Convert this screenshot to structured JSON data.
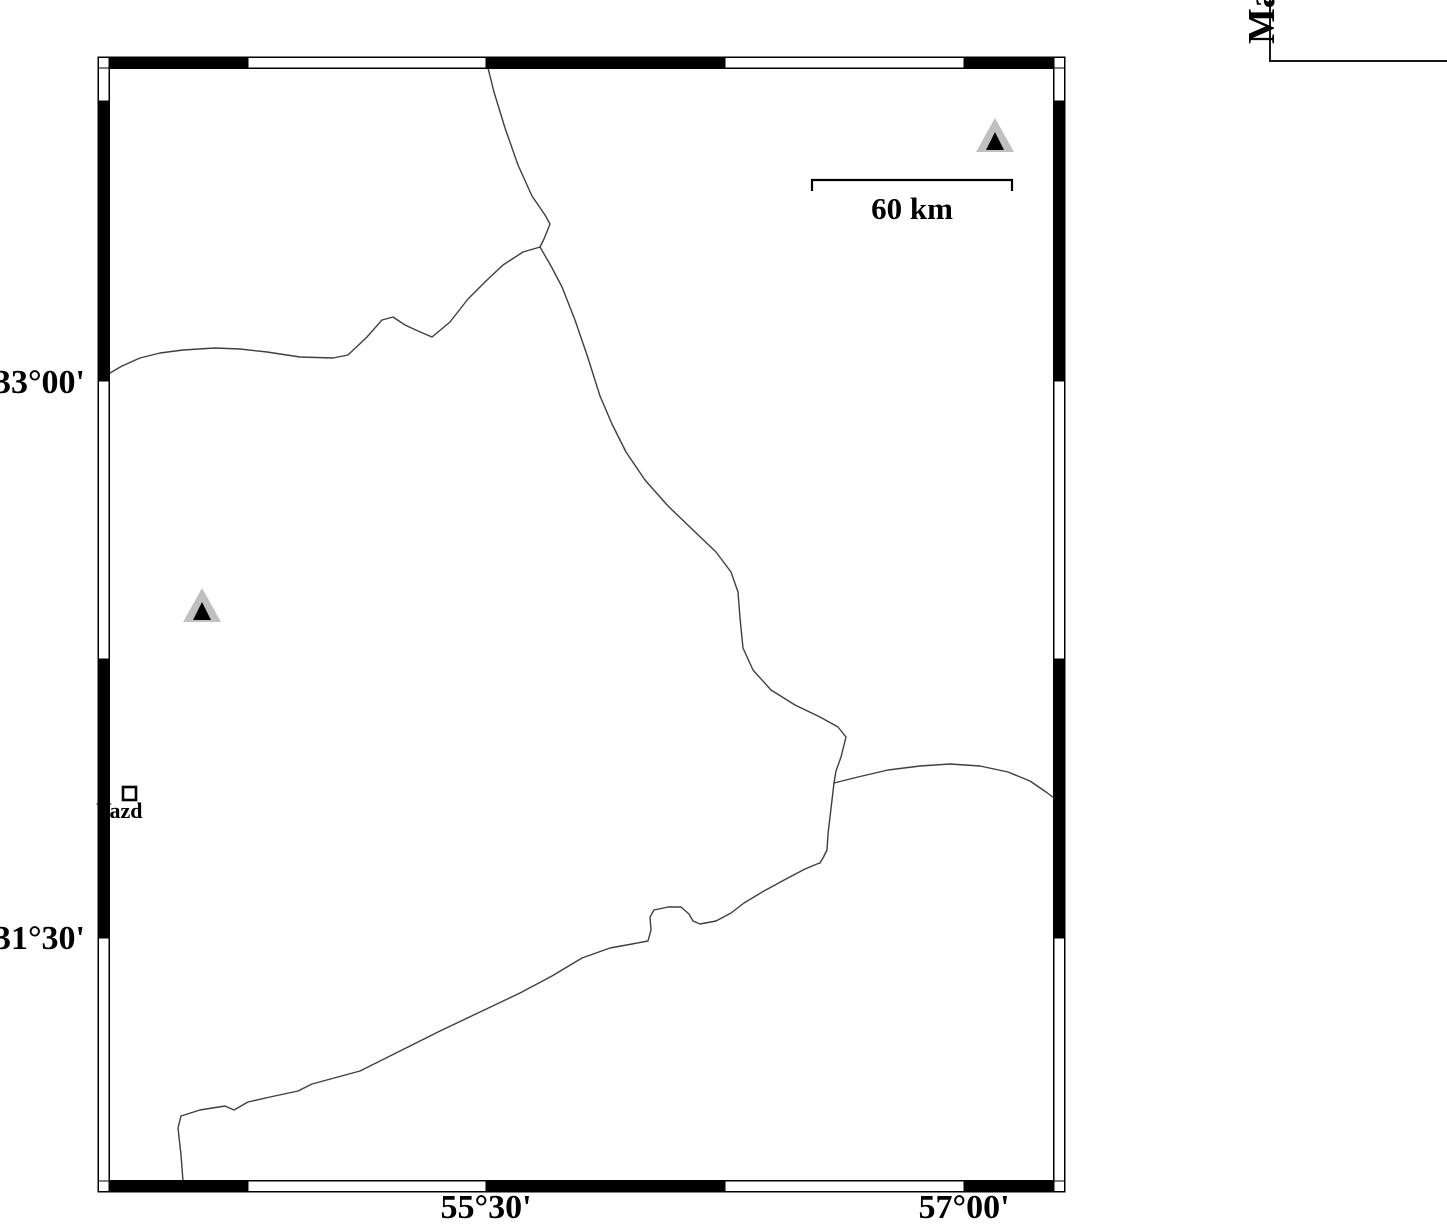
{
  "page": {
    "width": 1447,
    "height": 1229,
    "background": "#ffffff"
  },
  "colors": {
    "line": "#3f3f3f",
    "frame_black": "#000000",
    "frame_white": "#ffffff",
    "triangle_fill": "#c0c0c0",
    "triangle_core": "#000000",
    "ink": "#000000"
  },
  "map": {
    "axis": {
      "left_labels": [
        {
          "text": "33°00'",
          "y": 381
        },
        {
          "text": "31°30'",
          "y": 938
        }
      ],
      "bottom_labels": [
        {
          "text": "55°30'",
          "x": 486
        },
        {
          "text": "57°00'",
          "x": 964
        }
      ]
    },
    "frame": {
      "outer": [
        98,
        57,
        1065,
        1192
      ],
      "inner": [
        109,
        68,
        1054,
        1181
      ],
      "top_segments": [
        [
          109,
          248,
          "#000000"
        ],
        [
          248,
          486,
          "#ffffff"
        ],
        [
          486,
          725,
          "#000000"
        ],
        [
          725,
          964,
          "#ffffff"
        ],
        [
          964,
          1054,
          "#000000"
        ]
      ],
      "bottom_segments": [
        [
          109,
          248,
          "#000000"
        ],
        [
          248,
          486,
          "#ffffff"
        ],
        [
          486,
          725,
          "#000000"
        ],
        [
          725,
          964,
          "#ffffff"
        ],
        [
          964,
          1054,
          "#000000"
        ]
      ],
      "left_segments": [
        [
          68,
          101,
          "#ffffff"
        ],
        [
          101,
          381,
          "#000000"
        ],
        [
          381,
          659,
          "#ffffff"
        ],
        [
          659,
          938,
          "#000000"
        ],
        [
          938,
          1181,
          "#ffffff"
        ]
      ],
      "right_segments": [
        [
          68,
          101,
          "#ffffff"
        ],
        [
          101,
          381,
          "#000000"
        ],
        [
          381,
          659,
          "#ffffff"
        ],
        [
          659,
          938,
          "#000000"
        ],
        [
          938,
          1181,
          "#ffffff"
        ]
      ]
    },
    "scale_bar": {
      "x1": 812,
      "x2": 1012,
      "y": 180,
      "tick": 11,
      "label": "60 km"
    },
    "city": {
      "label": "Yazd",
      "square": [
        123,
        787,
        13,
        13
      ]
    },
    "markers": [
      {
        "name": "station-triangle-ne",
        "cx": 995,
        "base_y": 152
      },
      {
        "name": "station-triangle-w",
        "cx": 202,
        "base_y": 622
      }
    ],
    "legend": {
      "visible_title": "Ma"
    },
    "lines": [
      {
        "name": "boundary-line-west",
        "points": [
          [
            110,
            373
          ],
          [
            122,
            366
          ],
          [
            140,
            358
          ],
          [
            160,
            353
          ],
          [
            183,
            350
          ],
          [
            215,
            348
          ],
          [
            240,
            349
          ],
          [
            267,
            352
          ],
          [
            300,
            357
          ],
          [
            333,
            358
          ],
          [
            348,
            355
          ],
          [
            367,
            337
          ],
          [
            382,
            320
          ],
          [
            393,
            317
          ],
          [
            405,
            325
          ],
          [
            418,
            331
          ],
          [
            432,
            337
          ],
          [
            450,
            322
          ],
          [
            468,
            299
          ],
          [
            486,
            281
          ],
          [
            503,
            265
          ],
          [
            523,
            252
          ],
          [
            540,
            247
          ]
        ]
      },
      {
        "name": "boundary-line-north",
        "points": [
          [
            488,
            68
          ],
          [
            494,
            92
          ],
          [
            505,
            128
          ],
          [
            518,
            165
          ],
          [
            532,
            196
          ],
          [
            545,
            215
          ],
          [
            550,
            224
          ],
          [
            544,
            239
          ],
          [
            540,
            247
          ]
        ]
      },
      {
        "name": "boundary-line-southeast",
        "points": [
          [
            540,
            247
          ],
          [
            551,
            266
          ],
          [
            562,
            287
          ],
          [
            575,
            320
          ],
          [
            588,
            358
          ],
          [
            600,
            396
          ],
          [
            612,
            424
          ],
          [
            626,
            452
          ],
          [
            645,
            480
          ],
          [
            668,
            506
          ],
          [
            693,
            530
          ],
          [
            716,
            552
          ],
          [
            731,
            572
          ],
          [
            738,
            592
          ],
          [
            740,
            618
          ],
          [
            743,
            648
          ],
          [
            753,
            670
          ],
          [
            771,
            690
          ],
          [
            795,
            705
          ],
          [
            820,
            717
          ],
          [
            838,
            727
          ],
          [
            846,
            737
          ],
          [
            841,
            757
          ],
          [
            836,
            771
          ],
          [
            834,
            783
          ]
        ]
      },
      {
        "name": "boundary-line-east",
        "points": [
          [
            834,
            783
          ],
          [
            858,
            777
          ],
          [
            888,
            770
          ],
          [
            920,
            766
          ],
          [
            950,
            764
          ],
          [
            980,
            766
          ],
          [
            1008,
            772
          ],
          [
            1030,
            781
          ],
          [
            1046,
            792
          ],
          [
            1054,
            798
          ]
        ]
      },
      {
        "name": "boundary-line-south-branch",
        "points": [
          [
            834,
            783
          ],
          [
            832,
            800
          ],
          [
            830,
            817
          ],
          [
            828,
            834
          ],
          [
            827,
            850
          ],
          [
            823,
            858
          ],
          [
            820,
            863
          ]
        ]
      },
      {
        "name": "boundary-line-southwest",
        "points": [
          [
            183,
            1181
          ],
          [
            181,
            1155
          ],
          [
            178,
            1128
          ],
          [
            181,
            1116
          ],
          [
            200,
            1110
          ],
          [
            225,
            1106
          ],
          [
            234,
            1110
          ],
          [
            248,
            1102
          ],
          [
            270,
            1097
          ],
          [
            298,
            1091
          ],
          [
            312,
            1084
          ],
          [
            360,
            1071
          ],
          [
            400,
            1051
          ],
          [
            440,
            1031
          ],
          [
            480,
            1012
          ],
          [
            520,
            993
          ],
          [
            552,
            976
          ],
          [
            582,
            958
          ],
          [
            610,
            948
          ],
          [
            632,
            944
          ],
          [
            648,
            941
          ],
          [
            651,
            930
          ],
          [
            650,
            917
          ],
          [
            654,
            910
          ],
          [
            668,
            907
          ],
          [
            681,
            907
          ],
          [
            689,
            914
          ],
          [
            693,
            921
          ],
          [
            700,
            924
          ],
          [
            716,
            921
          ],
          [
            731,
            913
          ],
          [
            744,
            903
          ],
          [
            764,
            891
          ],
          [
            786,
            879
          ],
          [
            805,
            869
          ],
          [
            817,
            864
          ],
          [
            820,
            863
          ]
        ]
      }
    ]
  }
}
